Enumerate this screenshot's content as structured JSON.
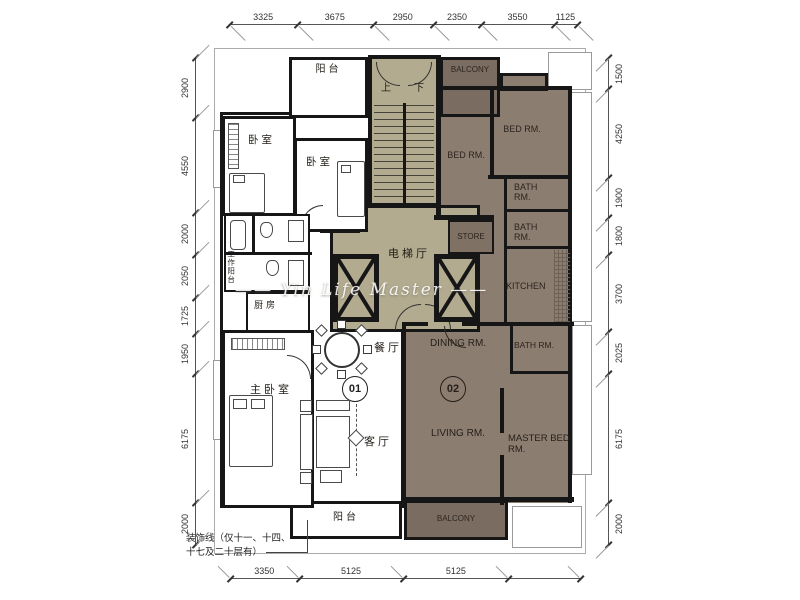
{
  "colors": {
    "wall": "#161616",
    "core_fill": "#b3ab8f",
    "unit2_fill": "#8c7d71",
    "balcony2_fill": "#7a6c60",
    "store_fill": "#7f7164"
  },
  "dim_chains": [
    {
      "id": "top",
      "o": "h",
      "values": [
        3325,
        3675,
        2950,
        2350,
        3550,
        1125
      ],
      "labels": [
        "3325",
        "3675",
        "2950",
        "2350",
        "3550",
        "1125"
      ]
    },
    {
      "id": "left",
      "o": "v",
      "values": [
        2900,
        4550,
        2000,
        2050,
        1725,
        1950,
        6175,
        2000
      ],
      "labels": [
        "2900",
        "4550",
        "2000",
        "2050",
        "1725",
        "1950",
        "6175",
        "2000"
      ]
    },
    {
      "id": "right",
      "o": "v",
      "values": [
        1500,
        4250,
        1900,
        1800,
        3700,
        2025,
        6175,
        2000
      ],
      "labels": [
        "1500",
        "4250",
        "1900",
        "1800",
        "3700",
        "2025",
        "6175",
        "2000"
      ]
    },
    {
      "id": "bottom",
      "o": "h",
      "values": [
        3350,
        5125,
        5125,
        3500
      ],
      "labels": [
        "3350",
        "5125",
        "5125",
        ""
      ]
    }
  ],
  "core": {
    "up": "上",
    "down": "下",
    "elevator_hall": "电梯厅",
    "storage": "储物"
  },
  "unit1": {
    "badge": "01",
    "balcony_top": "阳台",
    "bedroom_a": "卧室",
    "bedroom_b": "卧室",
    "work_balcony": "工作阳台",
    "kitchen": "厨房",
    "master_bedroom": "主卧室",
    "dining": "餐厅",
    "living": "客厅",
    "balcony_bottom": "阳台"
  },
  "unit2": {
    "badge": "02",
    "balcony_top": "BALCONY",
    "bedroom_a": "BED RM.",
    "bedroom_b": "BED RM.",
    "bath_a": "BATH RM.",
    "bath_b": "BATH RM.",
    "store": "STORE",
    "kitchen": "KITCHEN",
    "dining": "DINING RM.",
    "bath_c": "BATH RM.",
    "living": "LIVING RM.",
    "master_bedroom": "MASTER BED RM.",
    "balcony_bottom": "BALCONY"
  },
  "note": {
    "line1": "装饰线（仅十一、十四、",
    "line2": "十七及二十层有）"
  },
  "watermark": "—— Yin Life Master ——"
}
